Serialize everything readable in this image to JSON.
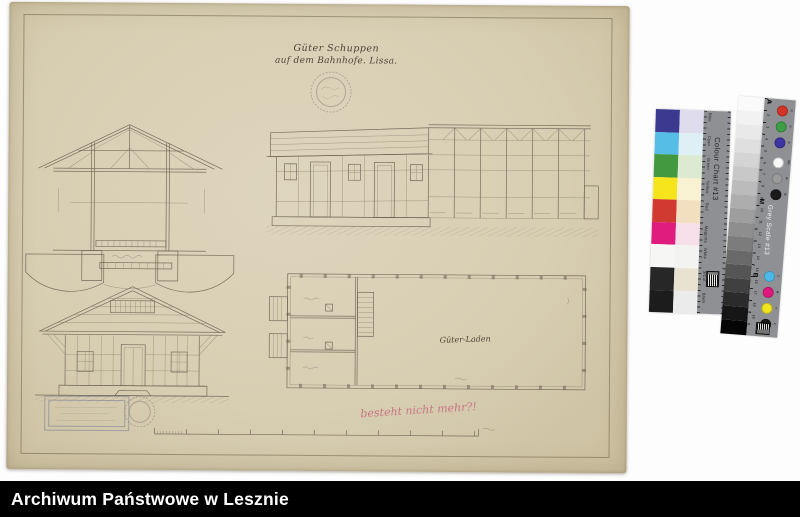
{
  "archive_bar": {
    "label": "Archiwum Państwowe w Lesznie",
    "background": "#000000",
    "text_color": "#ffffff"
  },
  "drawing": {
    "title_line1": "Güter Schuppen",
    "title_line2": "auf dem Bahnhofe. Lissa.",
    "plan_room_label": "Güter-Laden",
    "pink_annotation": "besteht nicht mehr?!",
    "ink_color": "#6b6252",
    "paper_color": "#d8ceb2",
    "annotation_color": "#c4687c"
  },
  "colour_chart": {
    "title": "Colour Chart #13",
    "strip_color": "#8f9094",
    "rows": [
      {
        "label": "Blue",
        "color": "#3b3a90",
        "pale": "#dedcec"
      },
      {
        "label": "Cyan",
        "color": "#55bde6",
        "pale": "#def0f5"
      },
      {
        "label": "Green",
        "color": "#42993f",
        "pale": "#dcead2"
      },
      {
        "label": "Yellow",
        "color": "#f6e51c",
        "pale": "#f8f2d2"
      },
      {
        "label": "Red",
        "color": "#d13a30",
        "pale": "#f2dfc0"
      },
      {
        "label": "Magenta",
        "color": "#e01c7e",
        "pale": "#f6dfe8"
      },
      {
        "label": "White",
        "color": "#f6f6f4",
        "pale": "#f3f3f1"
      },
      {
        "label": "3/Col",
        "color": "#272727",
        "pale": "#e8e3d0"
      },
      {
        "label": "Black",
        "color": "#1c1c1c",
        "pale": "#ebebeb"
      }
    ]
  },
  "grey_scale": {
    "title": "Grey Scale #13",
    "strip_color": "#8e9094",
    "markers": [
      "A",
      "M",
      "B"
    ],
    "steps": [
      "#fafafa",
      "#f2f2f2",
      "#e9e9e9",
      "#dfdfdf",
      "#d4d4d4",
      "#c8c8c8",
      "#bbbbbb",
      "#adadad",
      "#9e9e9e",
      "#8e8e8e",
      "#7c7c7c",
      "#696969",
      "#555555",
      "#404040",
      "#2b2b2b",
      "#161616",
      "#050505"
    ],
    "tick_numbers": [
      "1",
      "2",
      "3",
      "4",
      "5",
      "6",
      "7",
      "8",
      "9",
      "10",
      "11",
      "12",
      "13",
      "14",
      "15",
      "16",
      "17",
      "18",
      "19"
    ],
    "dots_top": [
      {
        "label": "R",
        "color": "#d23527"
      },
      {
        "label": "G",
        "color": "#3b9e44"
      },
      {
        "label": "B",
        "color": "#3d35a1"
      },
      {
        "label": "Wh",
        "color": "#f8f8f8"
      },
      {
        "label": "Gr",
        "color": "#9a9a9a"
      },
      {
        "label": "Bl",
        "color": "#1a1a1a"
      }
    ],
    "dots_bottom": [
      {
        "label": "C",
        "color": "#4db9e8"
      },
      {
        "label": "M",
        "color": "#e0187e"
      },
      {
        "label": "Y",
        "color": "#f2e51e"
      },
      {
        "label": "K",
        "color": "#1a1a1a"
      }
    ]
  }
}
